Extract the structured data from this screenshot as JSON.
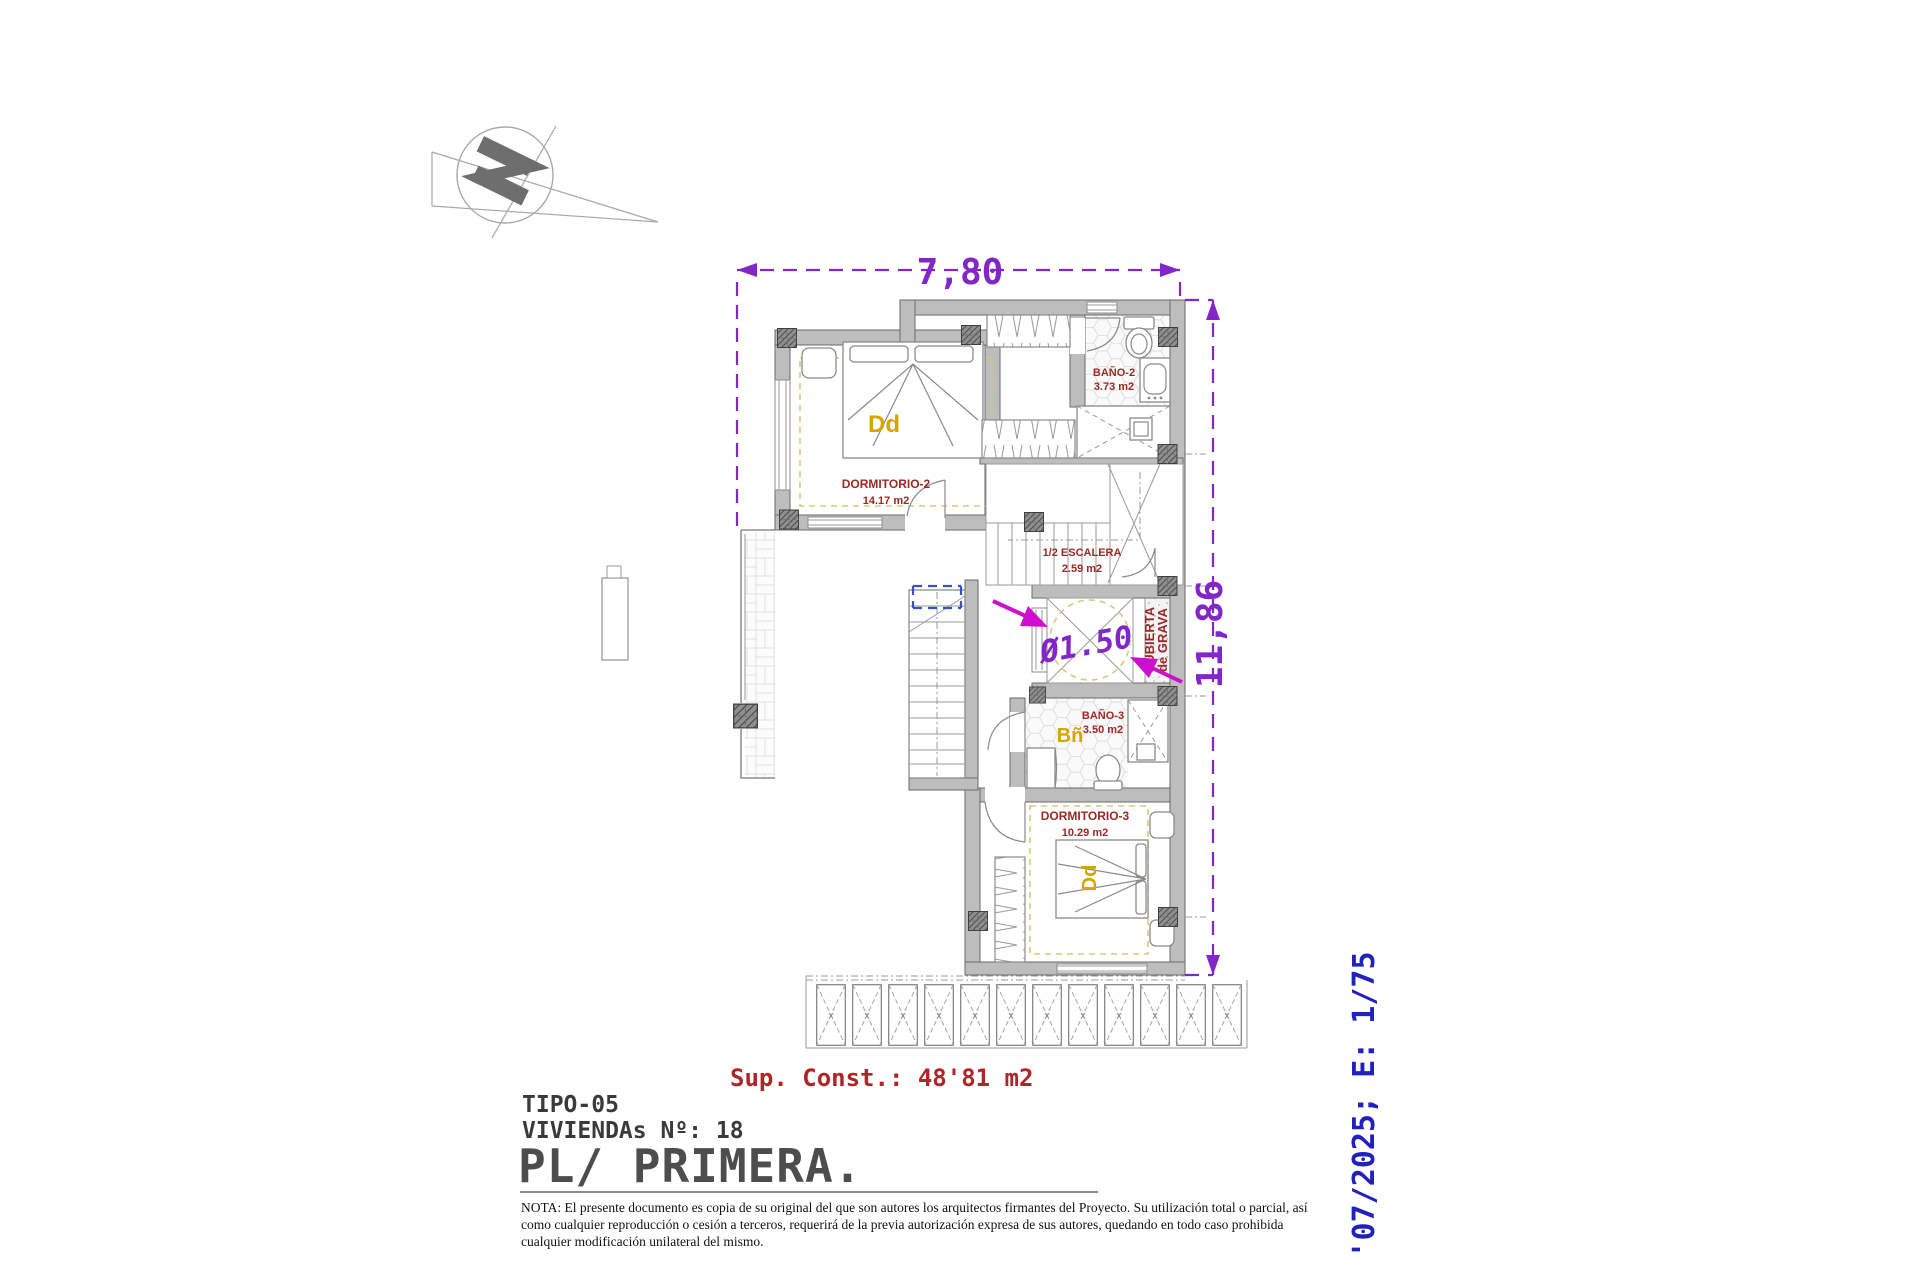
{
  "drawing": {
    "dim_width_label": "7,80",
    "dim_height_label": "11,86",
    "lift_diameter_label": "Ø1.50",
    "deck_panel_mark": "x",
    "rooms": {
      "dormitorio2": {
        "name": "DORMITORIO-2",
        "area": "14.17 m2",
        "bed_tag": "Dd"
      },
      "bano2": {
        "name": "BAÑO-2",
        "area": "3.73 m2"
      },
      "escalera": {
        "name": "1/2 ESCALERA",
        "area": "2.59 m2"
      },
      "bano3": {
        "name": "BAÑO-3",
        "area": "3.50 m2",
        "tag": "Bñ"
      },
      "dormitorio3": {
        "name": "DORMITORIO-3",
        "area": "10.29 m2",
        "bed_tag": "Dd"
      },
      "terraza": {
        "name": "T. DESCUBIERTA",
        "area": "27.17 m2"
      },
      "cubierta_grava": {
        "line1": "CUBIERTA",
        "line2": "de GRAVA"
      }
    }
  },
  "titleblock": {
    "sup_const": "Sup. Const.: 48'81 m2",
    "tipo": "TIPO-05",
    "viviendas": "VIVIENDAs Nº: 18",
    "planta": "PL/ PRIMERA.",
    "date_scale": "'07/2025; E: 1/75"
  },
  "note": {
    "line1": "NOTA: El presente documento es copia de su original del que son autores los arquitectos firmantes del Proyecto. Su utilización total o parcial, así",
    "line2": "como cualquier reproducción o cesión a terceros, requerirá  de la previa autorización expresa de sus autores, quedando en todo caso prohibida",
    "line3": "cualquier modificación unilateral del mismo."
  },
  "colors": {
    "dimension_purple": "#8226c9",
    "marker_magenta": "#cf0fcf",
    "room_label_red": "#9c2823",
    "sup_const_red": "#b02525",
    "tag_yellow": "#d8a400",
    "stamp_blue": "#2121bd",
    "wall_gray": "#bdbdbd"
  }
}
